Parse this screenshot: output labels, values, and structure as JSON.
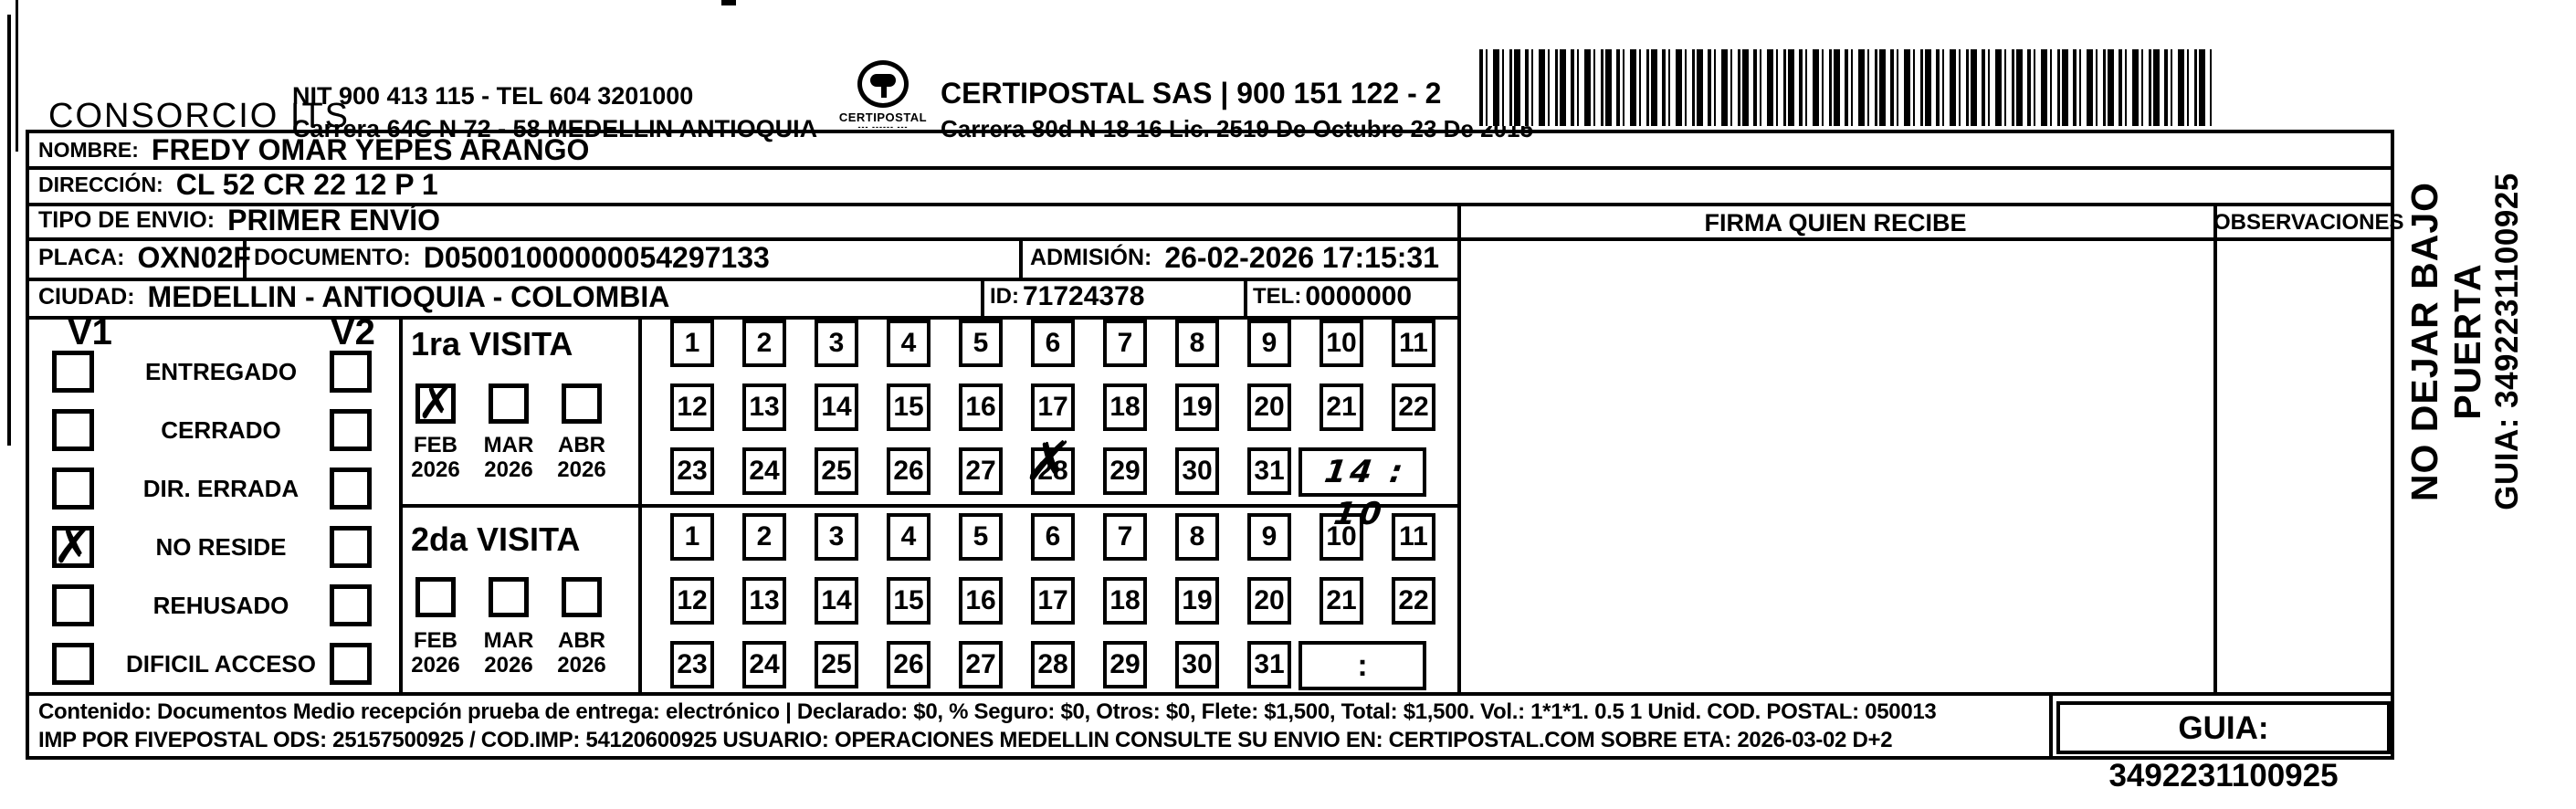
{
  "header": {
    "company": "CONSORCIO ITS",
    "nit_line1": "NIT 900 413 115 - TEL 604 3201000",
    "nit_line2": "Carrera 64C N 72 - 58 MEDELLIN ANTIOQUIA",
    "logo_name": "CERTIPOSTAL",
    "logo_dashes": "--- ------ ---",
    "certipostal_line1": "CERTIPOSTAL SAS | 900 151 122 - 2",
    "certipostal_line2": "Carrera 80d N 18 16  Lic. 2519 De Octubre 23 De 2015"
  },
  "recipient": {
    "nombre_label": "NOMBRE:",
    "nombre": "FREDY OMAR YEPES ARANGO",
    "direccion_label": "DIRECCIÓN:",
    "direccion": "CL 52 CR 22 12 P 1",
    "tipo_label": "TIPO DE ENVIO:",
    "tipo": "PRIMER ENVÍO",
    "placa_label": "PLACA:",
    "placa": "OXN02F",
    "documento_label": "DOCUMENTO:",
    "documento": "D05001000000054297133",
    "admision_label": "ADMISIÓN:",
    "admision": "26-02-2026 17:15:31",
    "ciudad_label": "CIUDAD:",
    "ciudad": "MEDELLIN - ANTIOQUIA - COLOMBIA",
    "id_label": "ID:",
    "id": "71724378",
    "tel_label": "TEL:",
    "tel": "0000000"
  },
  "right_panel": {
    "firma_header": "FIRMA QUIEN RECIBE",
    "observaciones_header": "OBSERVACIONES"
  },
  "status": {
    "v1_label": "V1",
    "v2_label": "V2",
    "options": [
      "ENTREGADO",
      "CERRADO",
      "DIR. ERRADA",
      "NO RESIDE",
      "REHUSADO",
      "DIFICIL ACCESO"
    ],
    "v1_checked_option": "NO RESIDE",
    "check_glyph": "✗"
  },
  "visits": {
    "visit1": {
      "title": "1ra VISITA",
      "months": [
        "FEB 2026",
        "MAR 2026",
        "ABR 2026"
      ],
      "checked_month": "FEB 2026",
      "days": [
        1,
        2,
        3,
        4,
        5,
        6,
        7,
        8,
        9,
        10,
        11,
        12,
        13,
        14,
        15,
        16,
        17,
        18,
        19,
        20,
        21,
        22,
        23,
        24,
        25,
        26,
        27,
        28,
        29,
        30,
        31
      ],
      "marked_day": 28,
      "time": "14 : 10"
    },
    "visit2": {
      "title": "2da VISITA",
      "months": [
        "FEB 2026",
        "MAR 2026",
        "ABR 2026"
      ],
      "checked_month": "",
      "days": [
        1,
        2,
        3,
        4,
        5,
        6,
        7,
        8,
        9,
        10,
        11,
        12,
        13,
        14,
        15,
        16,
        17,
        18,
        19,
        20,
        21,
        22,
        23,
        24,
        25,
        26,
        27,
        28,
        29,
        30,
        31
      ],
      "time": ":"
    }
  },
  "footer": {
    "line1": "Contenido: Documentos Medio recepción prueba de entrega: electrónico | Declarado: $0, % Seguro: $0, Otros: $0, Flete: $1,500, Total: $1,500. Vol.: 1*1*1. 0.5  1 Unid. COD. POSTAL: 050013",
    "line2": "IMP POR FIVEPOSTAL ODS: 25157500925 / COD.IMP: 54120600925 USUARIO: OPERACIONES MEDELLIN CONSULTE SU ENVIO EN: CERTIPOSTAL.COM SOBRE ETA: 2026-03-02 D+2",
    "guia_box": "GUIA: 3492231100925"
  },
  "side_text": {
    "line1": "NO DEJAR BAJO PUERTA",
    "line2": "GUIA: 3492231100925"
  }
}
